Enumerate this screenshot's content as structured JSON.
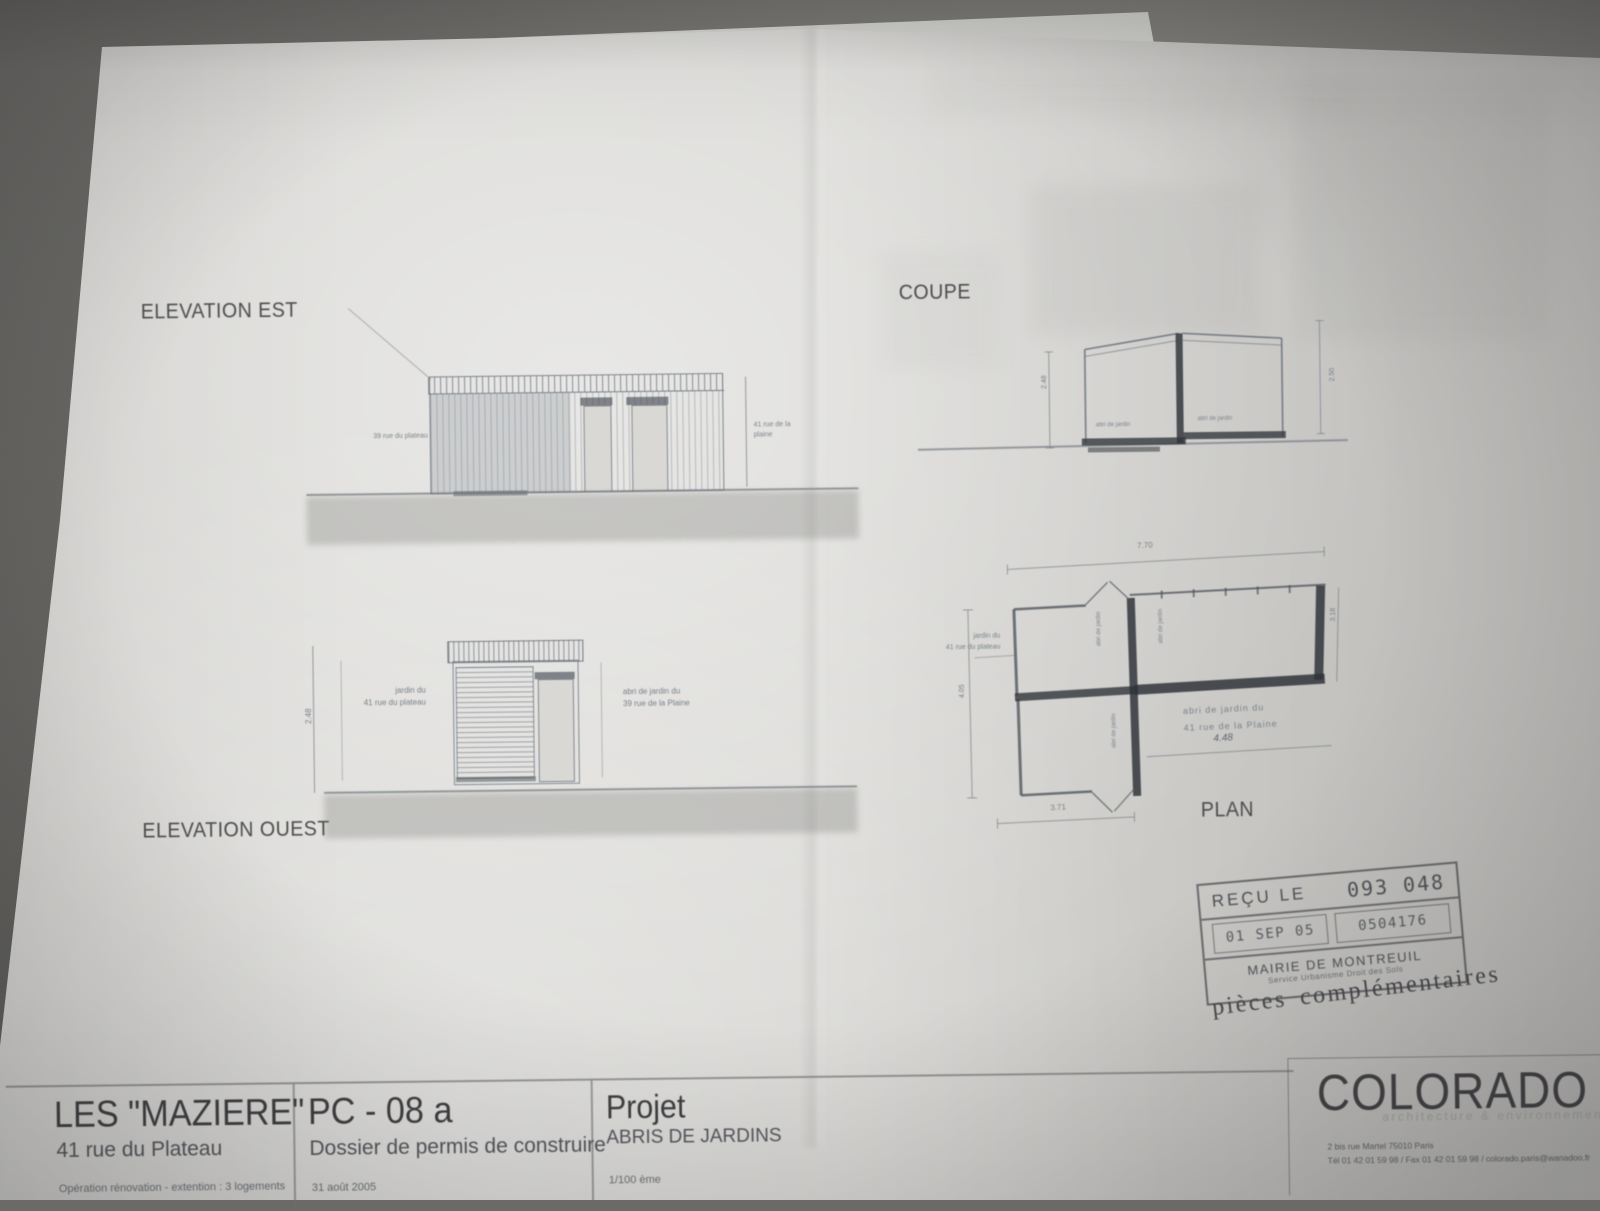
{
  "labels": {
    "elevation_est": "ELEVATION EST",
    "elevation_ouest": "ELEVATION OUEST",
    "coupe": "COUPE",
    "plan": "PLAN"
  },
  "annotations": {
    "est_left_note": "39 rue du plateau",
    "est_right_note": "41 rue de la plaine",
    "ouest_left_note_1": "jardin du",
    "ouest_left_note_2": "41 rue du plateau",
    "ouest_right_note_1": "abri  de jardin du",
    "ouest_right_note_2": "39 rue de la Plaine",
    "ouest_dim": "2.48",
    "coupe_room_left": "abri de jardin",
    "coupe_room_right": "abri de jardin",
    "coupe_dim_left": "2.48",
    "coupe_dim_right": "2.50",
    "plan_dim_top": "7.70",
    "plan_dim_right": "3.18",
    "plan_dim_left": "4.05",
    "plan_dim_bottom": "4.48",
    "plan_dim_bottom_left": "3.71",
    "plan_room_1": "abri de jardin",
    "plan_room_2": "abri de jardin",
    "plan_room_3": "abri de jardin",
    "plan_note_1": "abri  de jardin du",
    "plan_note_2": "41 rue de la Plaine",
    "plan_left_note_1": "jardin du",
    "plan_left_note_2": "41 rue du plateau"
  },
  "stamp": {
    "recu_le": "REÇU LE",
    "number": "093 048",
    "date": "01 SEP 05",
    "code": "0504176",
    "mairie": "MAIRIE  DE  MONTREUIL",
    "service": "Service Urbanisme   Droit des Sols",
    "note": "pièces complémentaires"
  },
  "titleblock": {
    "project_name": "LES \"MAZIERE\"",
    "project_address": "41 rue du Plateau",
    "project_operation": "Opération rénovation - extention : 3 logements",
    "doc_ref": "PC - 08 a",
    "doc_type": "Dossier de permis de construire",
    "doc_date": "31 août 2005",
    "section_label": "Projet",
    "section_title": "ABRIS DE JARDINS",
    "scale": "1/100 ème"
  },
  "firm": {
    "name": "COLORADO",
    "tagline": "architecture & environnement",
    "address": "2 bis rue Martel 75010 Paris",
    "contact": "Tél 01 42 01 59 98 / Fax 01 42 01 59 98 / colorado.paris@wanadoo.fr"
  }
}
